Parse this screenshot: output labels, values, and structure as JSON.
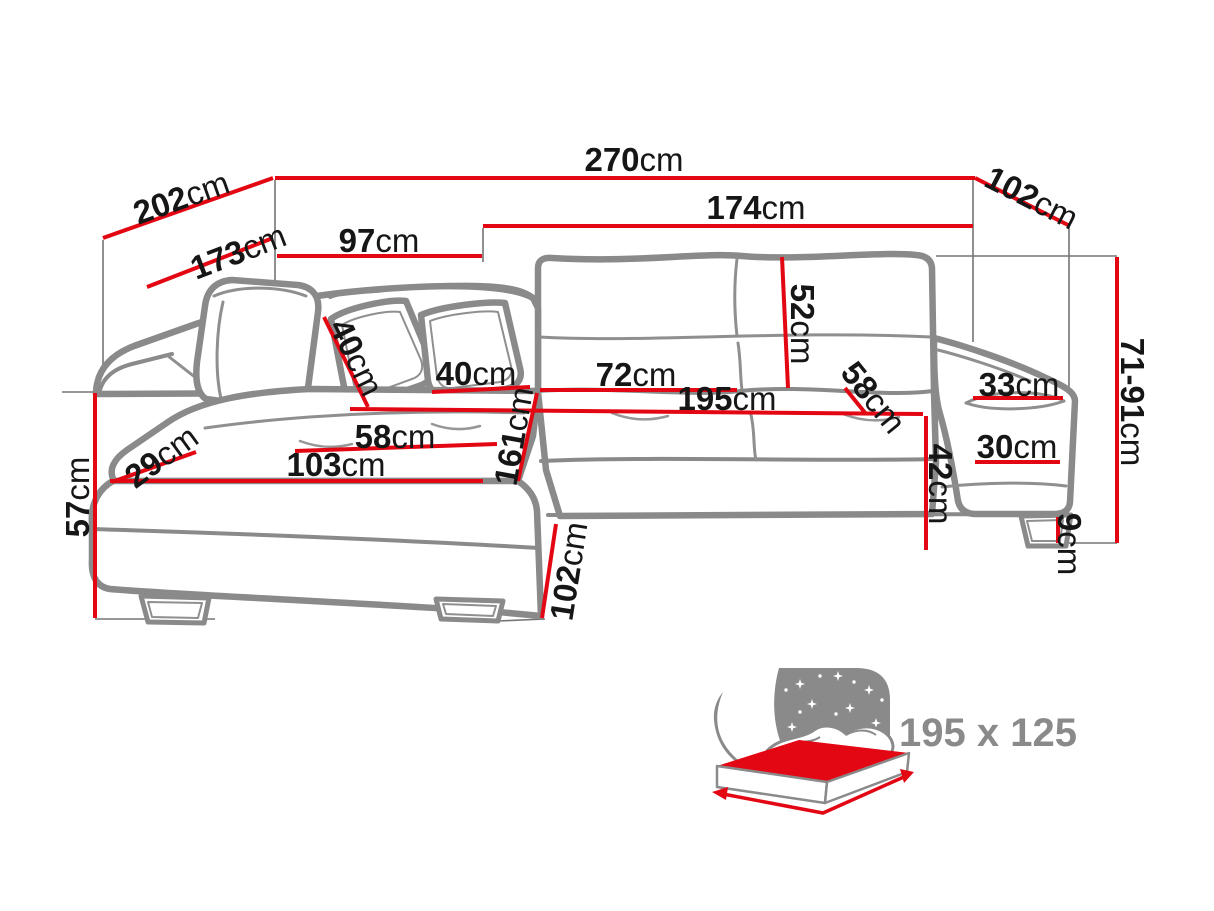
{
  "colors": {
    "dimension_red": "#e30613",
    "outline_gray": "#8a8a8a",
    "label_black": "#161616",
    "bed_label_gray": "#8a8a8a",
    "background": "#ffffff"
  },
  "dims": {
    "d270": {
      "value": "270",
      "unit": "cm"
    },
    "d202": {
      "value": "202",
      "unit": "cm"
    },
    "d173": {
      "value": "173",
      "unit": "cm"
    },
    "d97": {
      "value": "97",
      "unit": "cm"
    },
    "d174": {
      "value": "174",
      "unit": "cm"
    },
    "d102_top": {
      "value": "102",
      "unit": "cm"
    },
    "d52": {
      "value": "52",
      "unit": "cm"
    },
    "d71_91": {
      "value": "71-91",
      "unit": "cm"
    },
    "d33": {
      "value": "33",
      "unit": "cm"
    },
    "d30": {
      "value": "30",
      "unit": "cm"
    },
    "d9": {
      "value": "9",
      "unit": "cm"
    },
    "d42": {
      "value": "42",
      "unit": "cm"
    },
    "d58_back": {
      "value": "58",
      "unit": "cm"
    },
    "d72": {
      "value": "72",
      "unit": "cm"
    },
    "d195": {
      "value": "195",
      "unit": "cm"
    },
    "d161": {
      "value": "161",
      "unit": "cm"
    },
    "d40_pillow": {
      "value": "40",
      "unit": "cm"
    },
    "d40_seat": {
      "value": "40",
      "unit": "cm"
    },
    "d58_seat": {
      "value": "58",
      "unit": "cm"
    },
    "d103": {
      "value": "103",
      "unit": "cm"
    },
    "d29": {
      "value": "29",
      "unit": "cm"
    },
    "d57": {
      "value": "57",
      "unit": "cm"
    },
    "d102_depth": {
      "value": "102",
      "unit": "cm"
    }
  },
  "bed_icon": {
    "size_label": "195 x 125"
  }
}
